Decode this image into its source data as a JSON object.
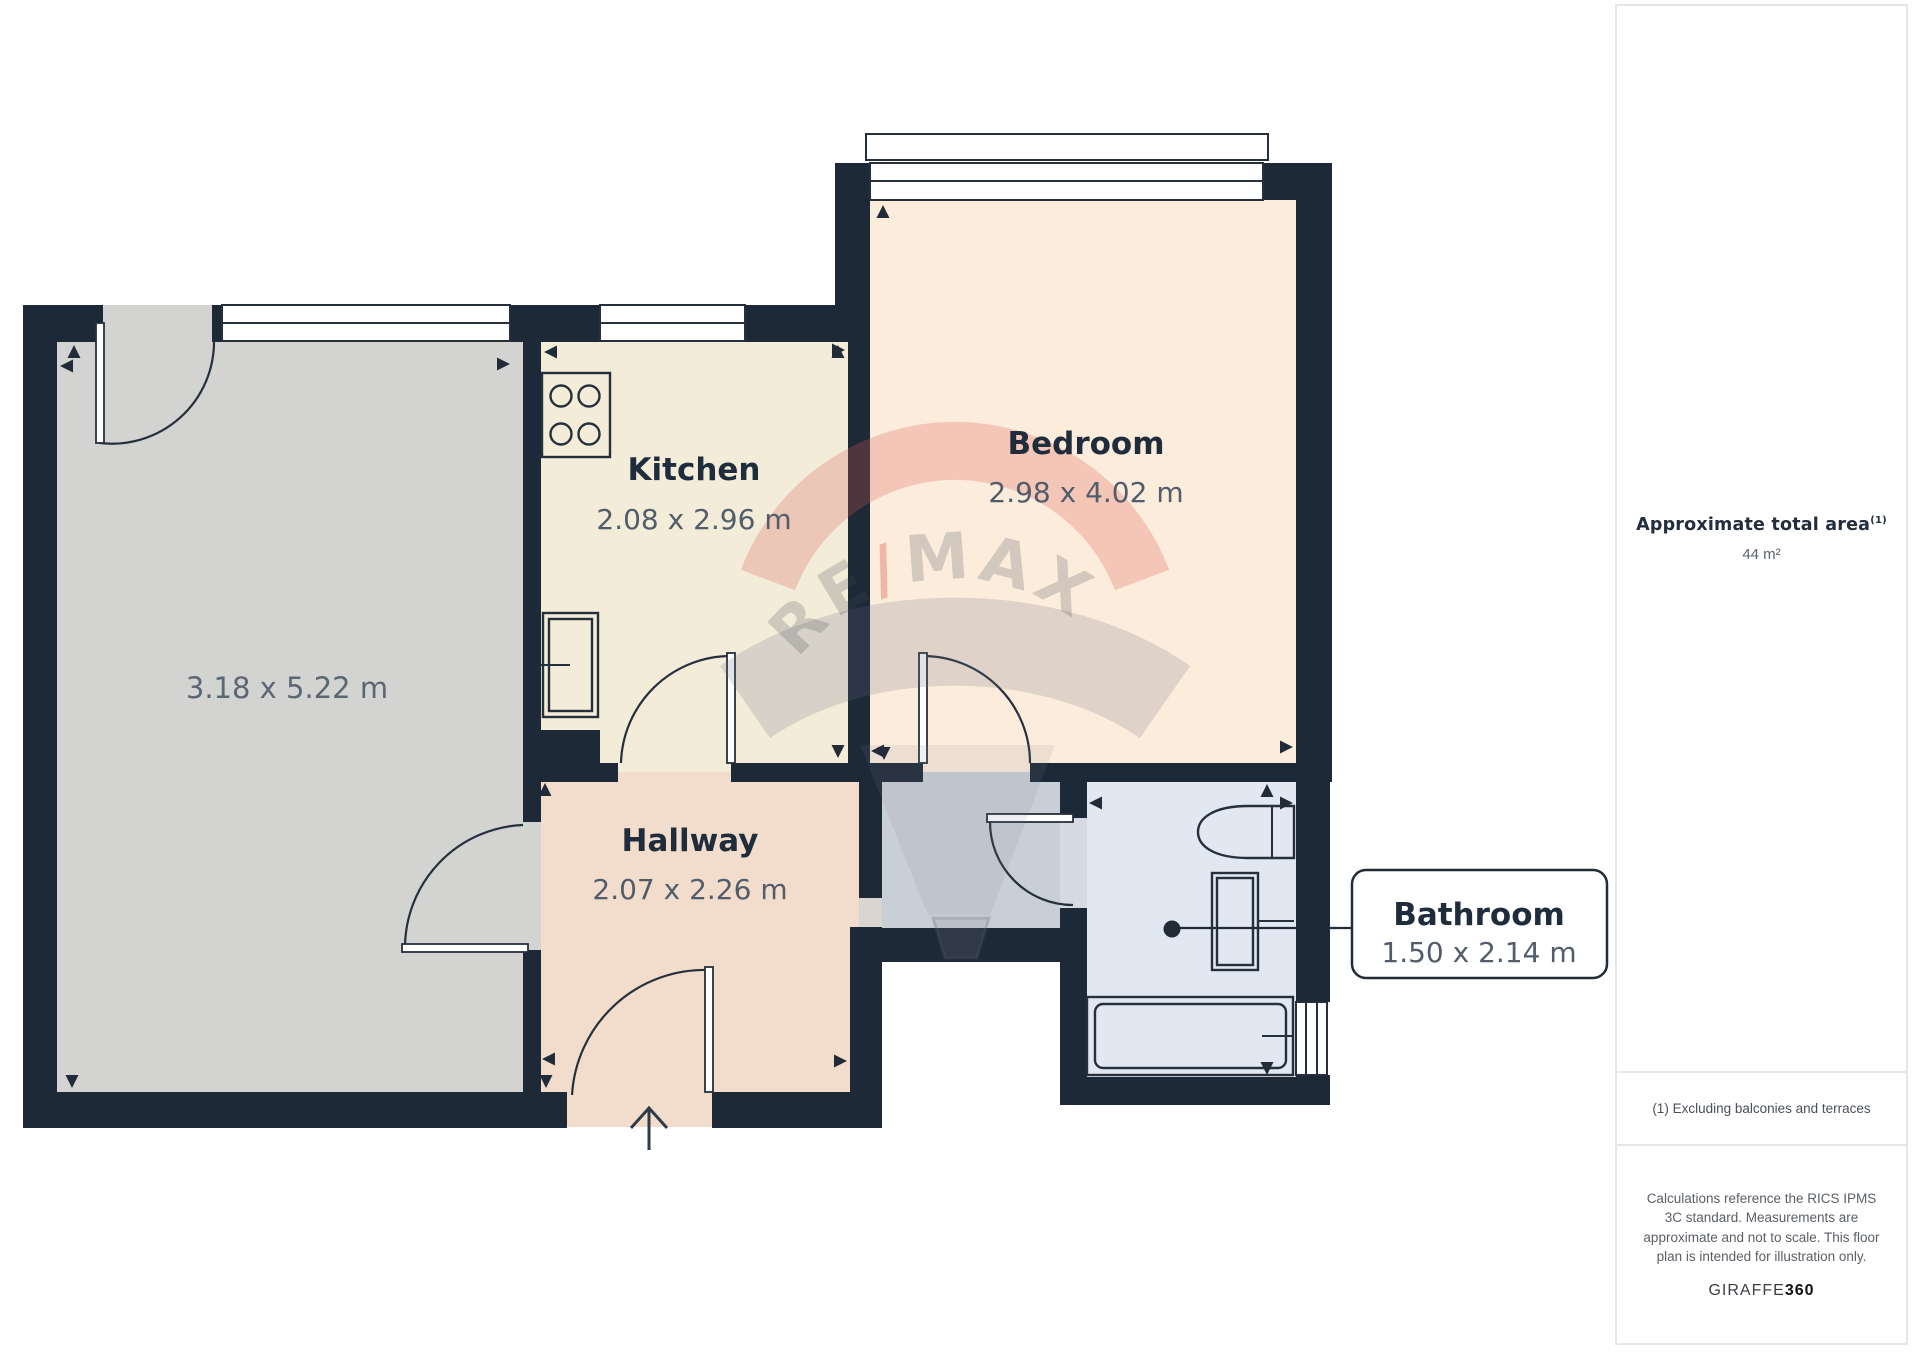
{
  "floorplan": {
    "rooms": {
      "living": {
        "dims": "3.18 x 5.22 m"
      },
      "kitchen": {
        "name": "Kitchen",
        "dims": "2.08 x 2.96 m"
      },
      "bedroom": {
        "name": "Bedroom",
        "dims": "2.98 x 4.02 m"
      },
      "hallway": {
        "name": "Hallway",
        "dims": "2.07 x 2.26 m"
      },
      "bathroom": {
        "name": "Bathroom",
        "dims": "1.50 x 2.14 m"
      }
    },
    "watermark": {
      "left": "RE",
      "slash": "/",
      "right": "MAX"
    },
    "colors": {
      "wall": "#1e2937",
      "living_floor": "#d3d4d2",
      "kitchen_floor": "#f2ecd9",
      "bedroom_floor": "#fcecdb",
      "hallway_floor": "#f2dccc",
      "bathroom_floor": "#e2e8f1",
      "corridor_floor": "#c9cfd7",
      "remax_red": "#dd5a50"
    }
  },
  "sidebar": {
    "area_title": "Approximate total area",
    "area_sup": "(1)",
    "area_value": "44 m²",
    "footnote": "(1) Excluding balconies and terraces",
    "disclaimer": "Calculations reference the RICS IPMS 3C standard. Measurements are approximate and not to scale. This floor plan is intended for illustration only.",
    "brand_name": "GIRAFFE",
    "brand_suffix": "360"
  }
}
